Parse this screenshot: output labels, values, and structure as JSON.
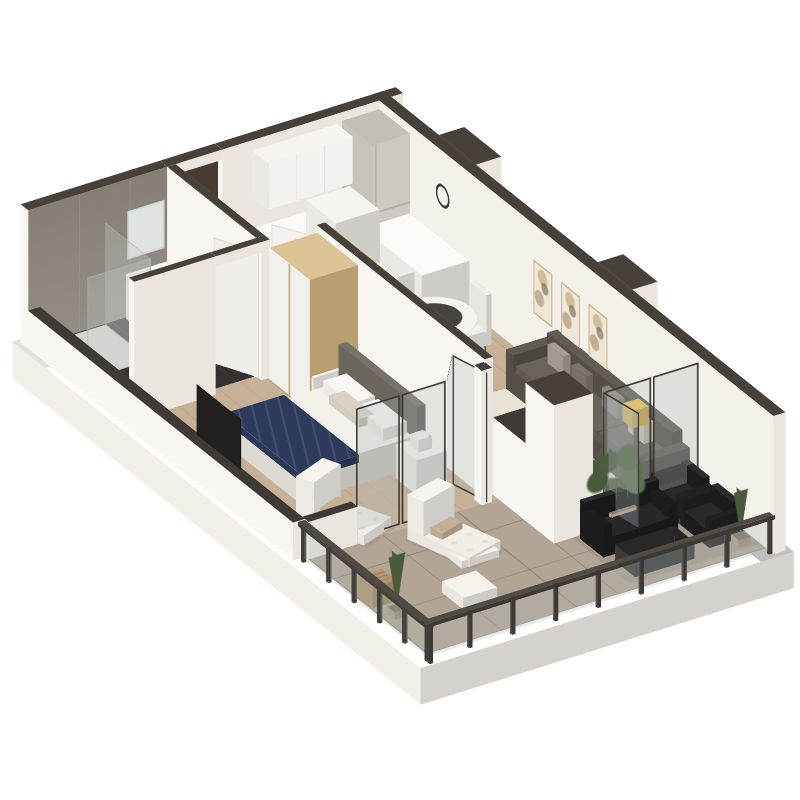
{
  "scene": {
    "type": "apartment-3d-floor-plan-render",
    "view": "isometric-cutaway-perspective",
    "background": "#ffffff",
    "description": "3D cutaway render of a one-bedroom apartment with balcony"
  },
  "palette": {
    "wall_top": "#48413a",
    "wall_top_low": "#3f3a35",
    "wall_white": "#f5f2ec",
    "wall_white_bright": "#f8f6f1",
    "wall_white_shade": "#eae6df",
    "wall_inner_ne": "#f4f1eb",
    "bath_tile": "#8b8379",
    "bath_floor": "#343230",
    "wood_floor": "#c6b096",
    "balcony_floor": "#b3a595",
    "slab": "#f2efe9",
    "glass_frame": "#3b3934",
    "glass_fill": "rgba(176,186,184,0.30)",
    "shower_glass": "rgba(200,210,208,0.28)",
    "chrome": "#aab2b0",
    "oak_top": "#dcc394",
    "oak_side": "#c9ac7c",
    "white_furniture": "#f2f0ea",
    "fridge": "#cdc9c1",
    "dark_door": "#4a3b30",
    "sofa_gray": "#57524b",
    "sofa_cushion": "#635d55",
    "pillow_light": "#a59f93",
    "pillow_mid": "#7b756b",
    "pillow_cream": "#cdc6b8",
    "rug_cream": "#e9e3d5",
    "navy_blanket": "#2d3a5c",
    "headboard_gray": "#6e6961",
    "tv_black": "#23211f",
    "outdoor_black": "#1d1d1f",
    "lamp_yellow": "#e3ba52",
    "art_frame": "#cbb089",
    "art_fill": "#eee6d6",
    "clock_ring": "#3a3835",
    "plant_green": "#55684a",
    "cypress_green": "#49593a",
    "crate_wood": "#b29770",
    "table_glass": "#47433e",
    "lounger_white": "#f1eee7"
  },
  "rooms": [
    {
      "name": "bathroom",
      "floor": "#343230",
      "walls": "gray stone tile"
    },
    {
      "name": "entry-hall",
      "floor": "wood"
    },
    {
      "name": "kitchen",
      "floor": "wood"
    },
    {
      "name": "dining-area",
      "floor": "wood"
    },
    {
      "name": "living-room",
      "floor": "wood"
    },
    {
      "name": "bedroom",
      "floor": "wood"
    },
    {
      "name": "balcony",
      "floor": "large beige tiles"
    }
  ],
  "furniture": [
    {
      "room": "bathroom",
      "item": "corner-shower-glass",
      "color": "rgba(200,210,208,0.28)"
    },
    {
      "room": "bathroom",
      "item": "vanity-drawer-unit",
      "color": "#f2f0ea"
    },
    {
      "room": "bathroom",
      "item": "wall-mirror",
      "color": "#dfe3e1"
    },
    {
      "room": "entry-hall",
      "item": "entry-door-open",
      "color": "#4a3b30"
    },
    {
      "room": "entry-hall",
      "item": "oak-wardrobe",
      "color": "#dcc394"
    },
    {
      "room": "entry-hall",
      "item": "tall-white-cabinet",
      "color": "#f2f0ea"
    },
    {
      "room": "kitchen",
      "item": "upper-cabinets",
      "color": "#f2f0ea"
    },
    {
      "room": "kitchen",
      "item": "base-cabinets",
      "color": "#f2f0ea"
    },
    {
      "room": "kitchen",
      "item": "fridge-tall-unit",
      "color": "#cdc9c1"
    },
    {
      "room": "dining-area",
      "item": "round-table-dark-center",
      "color": "#f5f3ef"
    },
    {
      "room": "dining-area",
      "item": "four-white-chairs",
      "color": "#f0eee8"
    },
    {
      "room": "living-room",
      "item": "gray-sofa-with-pillows",
      "color": "#57524b"
    },
    {
      "room": "living-room",
      "item": "cream-rug",
      "color": "#e9e3d5"
    },
    {
      "room": "living-room",
      "item": "floor-lamp-yellow-shade",
      "color": "#e3ba52"
    },
    {
      "room": "living-room",
      "item": "three-framed-artworks",
      "color": "#eee6d6"
    },
    {
      "room": "living-room",
      "item": "wall-clock",
      "color": "#3a3835"
    },
    {
      "room": "bedroom",
      "item": "double-bed-navy-blanket",
      "color": "#2d3a5c"
    },
    {
      "room": "bedroom",
      "item": "two-nightstands-with-lamps",
      "color": "#f2f0ea"
    },
    {
      "room": "bedroom",
      "item": "wall-tv",
      "color": "#23211f"
    },
    {
      "room": "bedroom",
      "item": "folding-glass-doors",
      "color": "rgba(176,186,184,0.30)"
    },
    {
      "room": "balcony",
      "item": "glass-balustrade",
      "color": "rgba(176,186,184,0.30)"
    },
    {
      "room": "balcony",
      "item": "black-outdoor-sofa",
      "color": "#1d1d1f"
    },
    {
      "room": "balcony",
      "item": "two-black-armchairs",
      "color": "#1e1e20"
    },
    {
      "room": "balcony",
      "item": "coffee-table",
      "color": "#3c3c3c"
    },
    {
      "room": "balcony",
      "item": "two-white-loungers",
      "color": "#f1eee7"
    },
    {
      "room": "balcony",
      "item": "white-pouf-and-floor-cushion",
      "color": "#f2efe9"
    },
    {
      "room": "balcony",
      "item": "potted-leafy-plant",
      "color": "#55684a"
    },
    {
      "room": "balcony",
      "item": "two-potted-cypresses",
      "color": "#49593a"
    },
    {
      "room": "balcony",
      "item": "wooden-crate",
      "color": "#b29770"
    }
  ]
}
